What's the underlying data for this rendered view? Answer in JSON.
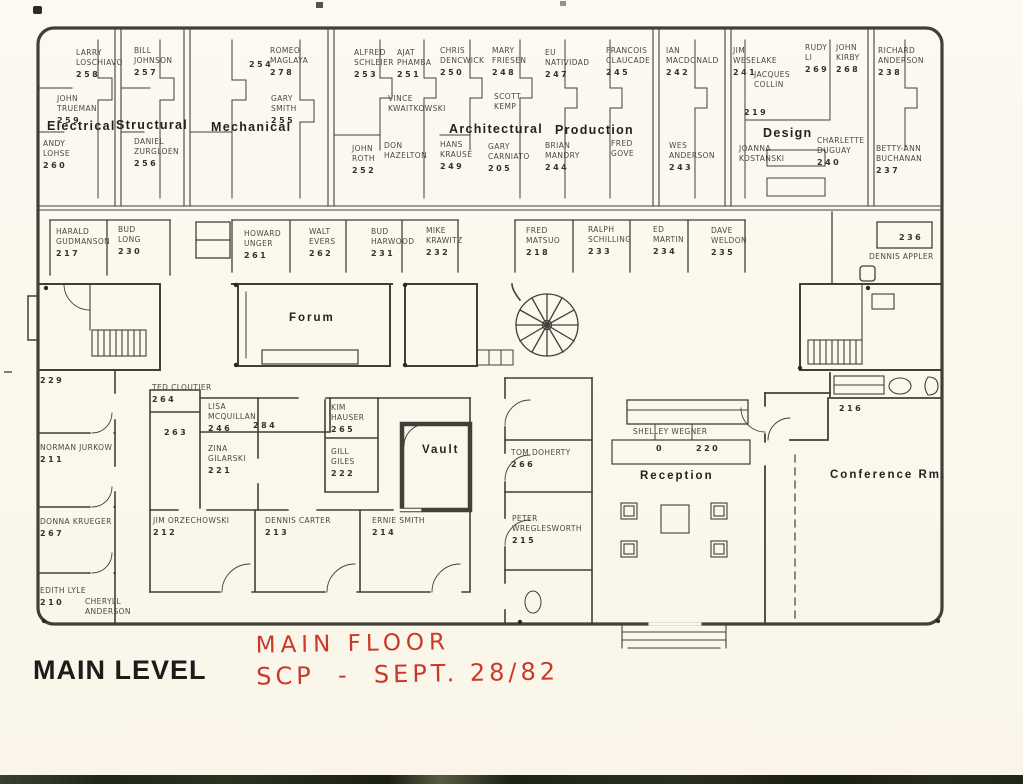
{
  "page": {
    "title": "MAIN LEVEL",
    "annotation_line1": "MAIN FLOOR",
    "annotation_line2": "SCP  -  SEPT. 28/82",
    "paper_color": "#fbf7ec",
    "ink_color": "#413f37",
    "red_color": "#c8392c"
  },
  "departments": [
    {
      "id": "electrical",
      "label": "Electrical",
      "x": 47,
      "y": 119
    },
    {
      "id": "structural",
      "label": "Structural",
      "x": 116,
      "y": 118
    },
    {
      "id": "mechanical",
      "label": "Mechanical",
      "x": 211,
      "y": 120
    },
    {
      "id": "architectural",
      "label": "Architectural",
      "x": 449,
      "y": 122
    },
    {
      "id": "production",
      "label": "Production",
      "x": 555,
      "y": 123
    },
    {
      "id": "design",
      "label": "Design",
      "x": 763,
      "y": 126
    }
  ],
  "areas": [
    {
      "id": "forum",
      "label": "Forum",
      "x": 289,
      "y": 312
    },
    {
      "id": "vault",
      "label": "Vault",
      "x": 422,
      "y": 444
    },
    {
      "id": "reception",
      "label": "Reception",
      "x": 640,
      "y": 470
    },
    {
      "id": "conference-room",
      "label": "Conference Rm.",
      "x": 830,
      "y": 469
    }
  ],
  "offices": [
    {
      "id": "larry-loschiavo",
      "lines": [
        "LARRY",
        "LOSCHIAVO"
      ],
      "number": "258",
      "x": 76,
      "y": 48
    },
    {
      "id": "bill-johnson",
      "lines": [
        "BILL",
        "JOHNSON"
      ],
      "number": "257",
      "x": 134,
      "y": 46
    },
    {
      "id": "romeo-maglaya",
      "lines": [
        "ROMEO",
        "MAGLAYA"
      ],
      "number": "278",
      "x": 270,
      "y": 46
    },
    {
      "id": "alfred-schleier",
      "lines": [
        "ALFRED",
        "SCHLEIER"
      ],
      "number": "253",
      "x": 354,
      "y": 48
    },
    {
      "id": "ajat-phamba",
      "lines": [
        "AJAT",
        "PHAMBA"
      ],
      "number": "251",
      "x": 397,
      "y": 48
    },
    {
      "id": "chris-dencwick",
      "lines": [
        "CHRIS",
        "DENCWICK"
      ],
      "number": "250",
      "x": 440,
      "y": 46
    },
    {
      "id": "mary-friesen",
      "lines": [
        "MARY",
        "FRIESEN"
      ],
      "number": "248",
      "x": 492,
      "y": 46
    },
    {
      "id": "eu-natividad",
      "lines": [
        "EU",
        "NATIVIDAD"
      ],
      "number": "247",
      "x": 545,
      "y": 48
    },
    {
      "id": "francois-claucade",
      "lines": [
        "FRANCOIS",
        "CLAUCADE"
      ],
      "number": "245",
      "x": 606,
      "y": 46
    },
    {
      "id": "ian-macdonald",
      "lines": [
        "IAN",
        "MACDONALD"
      ],
      "number": "242",
      "x": 666,
      "y": 46
    },
    {
      "id": "jim-weselake",
      "lines": [
        "JIM",
        "WESELAKE"
      ],
      "number": "241",
      "x": 733,
      "y": 46
    },
    {
      "id": "rudy-li",
      "lines": [
        "RUDY",
        "LI"
      ],
      "number": "269",
      "x": 805,
      "y": 43
    },
    {
      "id": "john-kirby",
      "lines": [
        "JOHN",
        "KIRBY"
      ],
      "number": "268",
      "x": 836,
      "y": 43
    },
    {
      "id": "richard-anderson",
      "lines": [
        "RICHARD",
        "ANDERSON"
      ],
      "number": "238",
      "x": 878,
      "y": 46
    },
    {
      "id": "jacques-collin",
      "lines": [
        "JACQUES",
        "COLLIN"
      ],
      "number": "",
      "x": 754,
      "y": 70
    },
    {
      "id": "john-trueman",
      "lines": [
        "JOHN",
        "TRUEMAN"
      ],
      "number": "259",
      "x": 57,
      "y": 94
    },
    {
      "id": "gary-smith",
      "lines": [
        "GARY",
        "SMITH"
      ],
      "number": "255",
      "x": 271,
      "y": 94
    },
    {
      "id": "vince-kwaitkowski",
      "lines": [
        "VINCE",
        "KWAITKOWSKI"
      ],
      "number": "",
      "x": 388,
      "y": 94
    },
    {
      "id": "scott-kemp",
      "lines": [
        "SCOTT",
        "KEMP"
      ],
      "number": "",
      "x": 494,
      "y": 92
    },
    {
      "id": "andy-lohse",
      "lines": [
        "ANDY",
        "LOHSE"
      ],
      "number": "260",
      "x": 43,
      "y": 139
    },
    {
      "id": "daniel-zurgloen",
      "lines": [
        "DANIEL",
        "ZURGLOEN"
      ],
      "number": "256",
      "x": 134,
      "y": 137
    },
    {
      "id": "john-roth",
      "lines": [
        "JOHN",
        "ROTH"
      ],
      "number": "252",
      "x": 352,
      "y": 144
    },
    {
      "id": "don-hazelton",
      "lines": [
        "DON",
        "HAZELTON"
      ],
      "number": "",
      "x": 384,
      "y": 141
    },
    {
      "id": "hans-krause",
      "lines": [
        "HANS",
        "KRAUSE"
      ],
      "number": "249",
      "x": 440,
      "y": 140
    },
    {
      "id": "gary-carniato",
      "lines": [
        "GARY",
        "CARNIATO"
      ],
      "number": "205",
      "x": 488,
      "y": 142
    },
    {
      "id": "brian-mandry",
      "lines": [
        "BRIAN",
        "MANDRY"
      ],
      "number": "244",
      "x": 545,
      "y": 141
    },
    {
      "id": "fred-gove",
      "lines": [
        "FRED",
        "GOVE"
      ],
      "number": "",
      "x": 611,
      "y": 139
    },
    {
      "id": "wes-anderson",
      "lines": [
        "WES",
        "ANDERSON"
      ],
      "number": "243",
      "x": 669,
      "y": 141
    },
    {
      "id": "joanna-kostanski",
      "lines": [
        "JOANNA",
        "KOSTANSKI"
      ],
      "number": "",
      "x": 739,
      "y": 144
    },
    {
      "id": "charlette-duguay",
      "lines": [
        "CHARLETTE",
        "DUGUAY"
      ],
      "number": "240",
      "x": 817,
      "y": 136
    },
    {
      "id": "betty-ann-buchanan",
      "lines": [
        "BETTY-ANN",
        "BUCHANAN"
      ],
      "number": "237",
      "x": 876,
      "y": 144
    },
    {
      "id": "harald-gudmanson",
      "lines": [
        "HARALD",
        "GUDMANSON"
      ],
      "number": "217",
      "x": 56,
      "y": 227
    },
    {
      "id": "bud-long",
      "lines": [
        "BUD",
        "LONG"
      ],
      "number": "230",
      "x": 118,
      "y": 225
    },
    {
      "id": "howard-unger",
      "lines": [
        "HOWARD",
        "UNGER"
      ],
      "number": "261",
      "x": 244,
      "y": 229
    },
    {
      "id": "walt-evers",
      "lines": [
        "WALT",
        "EVERS"
      ],
      "number": "262",
      "x": 309,
      "y": 227
    },
    {
      "id": "bud-harwood",
      "lines": [
        "BUD",
        "HARWOOD"
      ],
      "number": "231",
      "x": 371,
      "y": 227
    },
    {
      "id": "mike-krawitz",
      "lines": [
        "MIKE",
        "KRAWITZ"
      ],
      "number": "232",
      "x": 426,
      "y": 226
    },
    {
      "id": "fred-matsuo",
      "lines": [
        "FRED",
        "MATSUO"
      ],
      "number": "218",
      "x": 526,
      "y": 226
    },
    {
      "id": "ralph-schilling",
      "lines": [
        "RALPH",
        "SCHILLING"
      ],
      "number": "233",
      "x": 588,
      "y": 225
    },
    {
      "id": "ed-martin",
      "lines": [
        "ED",
        "MARTIN"
      ],
      "number": "234",
      "x": 653,
      "y": 225
    },
    {
      "id": "dave-weldon",
      "lines": [
        "DAVE",
        "WELDON"
      ],
      "number": "235",
      "x": 711,
      "y": 226
    },
    {
      "id": "dennis-appler",
      "lines": [
        "DENNIS APPLER"
      ],
      "number": "",
      "x": 869,
      "y": 252
    },
    {
      "id": "ted-cloutier",
      "lines": [
        "TED CLOUTIER"
      ],
      "number": "264",
      "x": 152,
      "y": 383
    },
    {
      "id": "lisa-mcquillan",
      "lines": [
        "LISA",
        "MCQUILLAN"
      ],
      "number": "246",
      "x": 208,
      "y": 402
    },
    {
      "id": "zina-gilarski",
      "lines": [
        "ZINA",
        "GILARSKI"
      ],
      "number": "221",
      "x": 208,
      "y": 444
    },
    {
      "id": "kim-hauser",
      "lines": [
        "KIM",
        "HAUSER"
      ],
      "number": "265",
      "x": 331,
      "y": 403
    },
    {
      "id": "gill-giles",
      "lines": [
        "GILL",
        "GILES"
      ],
      "number": "222",
      "x": 331,
      "y": 447
    },
    {
      "id": "tom-doherty",
      "lines": [
        "TOM DOHERTY"
      ],
      "number": "266",
      "x": 511,
      "y": 448
    },
    {
      "id": "shelley-wegner",
      "lines": [
        "SHELLEY WEGNER"
      ],
      "number": "",
      "x": 633,
      "y": 427
    },
    {
      "id": "norman-jurkow",
      "lines": [
        "NORMAN JURKOW"
      ],
      "number": "211",
      "x": 40,
      "y": 443
    },
    {
      "id": "donna-krueger",
      "lines": [
        "DONNA KRUEGER"
      ],
      "number": "267",
      "x": 40,
      "y": 517
    },
    {
      "id": "jim-orzechowski",
      "lines": [
        "JIM ORZECHOWSKI"
      ],
      "number": "212",
      "x": 153,
      "y": 516
    },
    {
      "id": "dennis-carter",
      "lines": [
        "DENNIS CARTER"
      ],
      "number": "213",
      "x": 265,
      "y": 516
    },
    {
      "id": "ernie-smith",
      "lines": [
        "ERNIE SMITH"
      ],
      "number": "214",
      "x": 372,
      "y": 516
    },
    {
      "id": "peter-wreglesworth",
      "lines": [
        "PETER",
        "WREGLESWORTH"
      ],
      "number": "215",
      "x": 512,
      "y": 514
    },
    {
      "id": "edith-lyle",
      "lines": [
        "EDITH LYLE"
      ],
      "number": "210",
      "x": 40,
      "y": 586
    },
    {
      "id": "cheryll-anderson",
      "lines": [
        "CHERYLL",
        "ANDERSON"
      ],
      "number": "",
      "x": 85,
      "y": 597
    }
  ],
  "room_numbers": [
    {
      "id": "254",
      "number": "254",
      "x": 249,
      "y": 60
    },
    {
      "id": "219",
      "number": "219",
      "x": 744,
      "y": 108
    },
    {
      "id": "236",
      "number": "236",
      "x": 899,
      "y": 233
    },
    {
      "id": "229",
      "number": "229",
      "x": 40,
      "y": 376
    },
    {
      "id": "263",
      "number": "263",
      "x": 164,
      "y": 428
    },
    {
      "id": "284",
      "number": "284",
      "x": 253,
      "y": 421
    },
    {
      "id": "216",
      "number": "216",
      "x": 839,
      "y": 404
    },
    {
      "id": "reception-left",
      "number": "0",
      "x": 656,
      "y": 444
    },
    {
      "id": "reception-right",
      "number": "220",
      "x": 696,
      "y": 444
    }
  ]
}
